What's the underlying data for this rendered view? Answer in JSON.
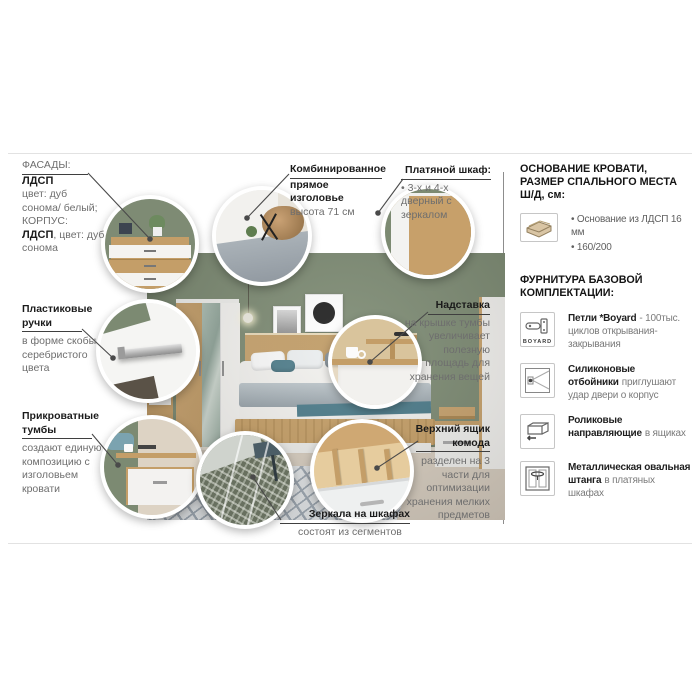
{
  "labels": {
    "facades": {
      "heading": "ФАСАДЫ:",
      "material": "ЛДСП",
      "material_desc": "цвет: дуб сонома/ белый;",
      "corpus_heading": "КОРПУС:",
      "corpus_material": "ЛДСП",
      "corpus_desc": ", цвет: дуб сонома"
    },
    "headboard": {
      "title_line1": "Комбинированное",
      "title_line2": "прямое изголовье",
      "desc": "высота 71 см"
    },
    "wardrobe": {
      "title": "Платяной шкаф:",
      "desc": "• 3-х и 4-х дверный с зеркалом"
    },
    "handles": {
      "title": "Пластиковые ручки",
      "desc": "в форме скобы серебристого цвета"
    },
    "nightstands": {
      "title": "Прикроватные тумбы",
      "desc": "создают единую композицию с изголовьем кровати"
    },
    "mirrors": {
      "title": "Зеркала на шкафах",
      "desc": "состоят из сегментов"
    },
    "shelf_topper": {
      "title": "Надставка",
      "desc": "на крышке тумбы увеличивает полезную площадь для хранения вещей"
    },
    "top_drawer": {
      "title": "Верхний ящик комода",
      "desc": "разделен на 3 части для оптимизации хранения мелких предметов"
    }
  },
  "sidebar": {
    "bed_base": {
      "title": "ОСНОВАНИЕ КРОВАТИ, РАЗМЕР СПАЛЬНОГО МЕСТА Ш/Д, см:",
      "icon": "bed-base-icon",
      "bullet1": "• Основание из ЛДСП 16 мм",
      "bullet2": "• 160/200"
    },
    "hardware": {
      "title": "ФУРНИТУРА БАЗОВОЙ КОМПЛЕКТАЦИИ:",
      "items": [
        {
          "icon": "hinge-icon",
          "icon_label": "BOYARD",
          "strong": "Петли *Boyard",
          "rest": "- 100тыс. циклов открывания-закрывания"
        },
        {
          "icon": "door-bumper-icon",
          "strong": "Силиконовые отбойники",
          "rest": "приглушают удар двери о корпус"
        },
        {
          "icon": "drawer-roller-icon",
          "strong": "Роликовые направляющие",
          "rest": "в ящиках"
        },
        {
          "icon": "wardrobe-rod-icon",
          "strong": "Металлическая овальная штанга",
          "rest": "в платяных шкафах"
        }
      ]
    }
  },
  "colors": {
    "wall_green": "#7c8a72",
    "oak": "#c7a06a",
    "white_furniture": "#f3f2ef",
    "callout_line": "#4a4a4a",
    "title_text": "#1b1b1b",
    "body_text": "#6e6e6e"
  }
}
